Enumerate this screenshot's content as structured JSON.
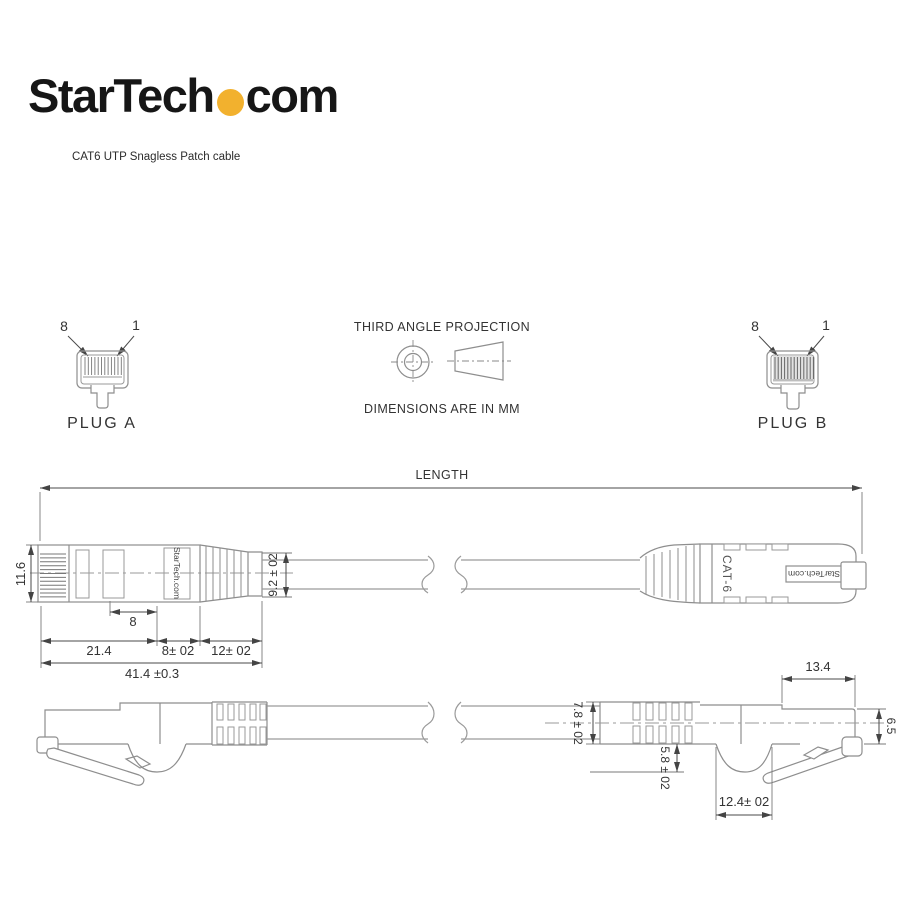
{
  "brand": {
    "logo_left": "StarTech",
    "logo_right": "com",
    "dot_color": "#F2B12E",
    "subtitle": "CAT6 UTP Snagless Patch cable"
  },
  "projection": {
    "title": "THIRD ANGLE PROJECTION",
    "units": "DIMENSIONS ARE IN MM"
  },
  "plug_a": {
    "label": "PLUG A",
    "pin_left": "8",
    "pin_right": "1"
  },
  "plug_b": {
    "label": "PLUG B",
    "pin_left": "8",
    "pin_right": "1"
  },
  "length": {
    "label": "LENGTH"
  },
  "side_view": {
    "brand_on_plug": "StarTech.com",
    "plug_b_marking": "CAT-6",
    "plug_b_label": "StarTech.com",
    "dim_height": "11.6",
    "dim_boot_height": "9.2 ± 02",
    "dim_latch": "8",
    "dim_seg1": "21.4",
    "dim_seg2": "8± 02",
    "dim_seg3": "12± 02",
    "dim_total": "41.4 ±0.3"
  },
  "profile_view": {
    "dim_boot_height": "7.8 ± 02",
    "dim_top_length": "13.4",
    "dim_tip_height": "6.5",
    "dim_latch_depth": "5.8 ± 02",
    "dim_latch_width": "12.4± 02"
  }
}
